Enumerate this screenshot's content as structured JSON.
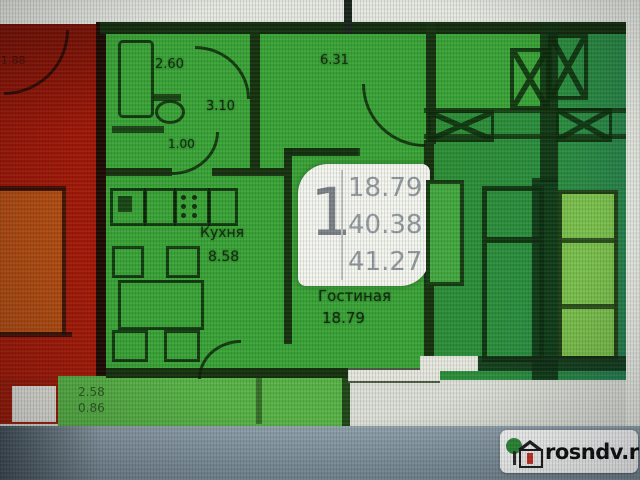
{
  "floor_plan": {
    "unit_badge": {
      "rooms_count": "1",
      "line1": "18.79",
      "line2": "40.38",
      "line3": "41.27"
    },
    "rooms": {
      "kitchen": {
        "label": "Кухня",
        "area": "8.58"
      },
      "living_room": {
        "label": "Гостиная",
        "area": "18.79"
      }
    },
    "dimensions": {
      "bathroom_width": "2.60",
      "hallway_width": "6.31",
      "bathroom_length": "3.10",
      "wc_width": "1.00",
      "adjacent_left": "1.88",
      "lower_left_a": "2.58",
      "lower_left_b": "0.86"
    },
    "colors": {
      "unit_green": "#3ba538",
      "adjacent_red": "#a11707",
      "adjacent_orange": "#b54d12",
      "right_wing_green": "#2e9134",
      "wall_dark": "#16320f"
    }
  },
  "watermark": {
    "site": "rosndv.ru"
  }
}
